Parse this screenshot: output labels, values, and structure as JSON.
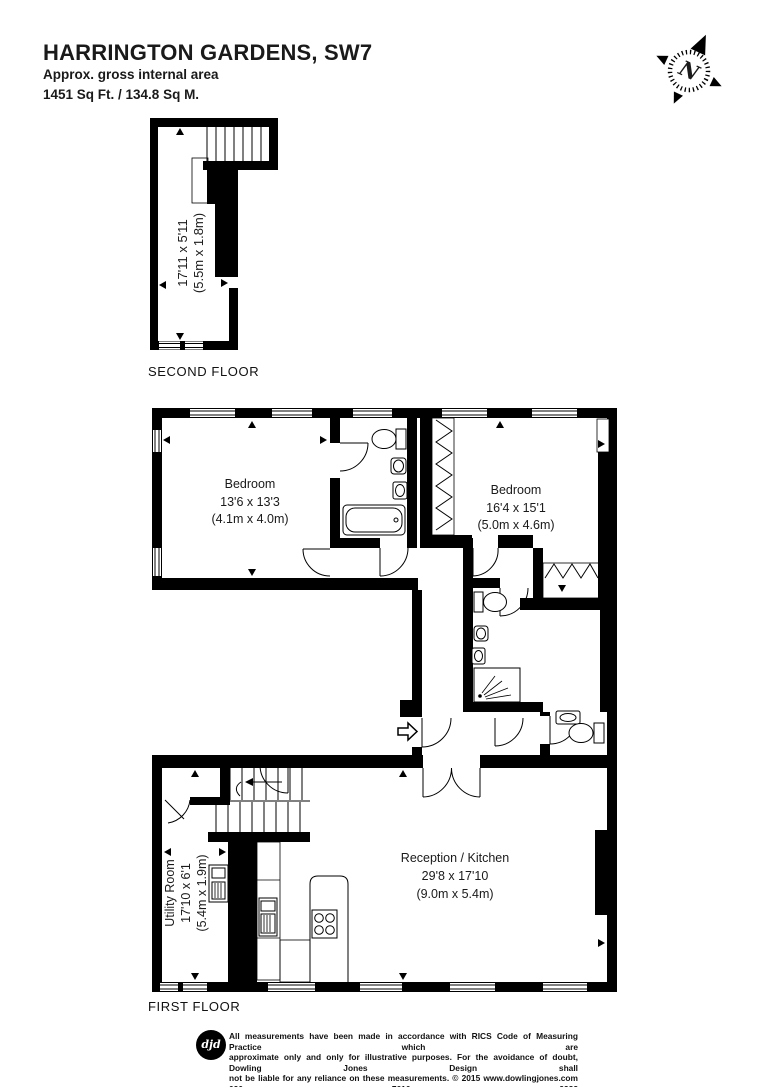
{
  "header": {
    "title": "HARRINGTON GARDENS, SW7",
    "subtitle": "Approx. gross internal area",
    "area": "1451 Sq Ft. / 134.8 Sq M."
  },
  "compass": {
    "label": "N"
  },
  "floors": {
    "second": {
      "label": "SECOND FLOOR",
      "room": {
        "imperial": "17'11 x 5'11",
        "metric": "(5.5m x 1.8m)"
      }
    },
    "first": {
      "label": "FIRST FLOOR",
      "rooms": {
        "bedroom1": {
          "name": "Bedroom",
          "imperial": "13'6 x 13'3",
          "metric": "(4.1m x 4.0m)"
        },
        "bedroom2": {
          "name": "Bedroom",
          "imperial": "16'4 x 15'1",
          "metric": "(5.0m x 4.6m)"
        },
        "reception": {
          "name": "Reception / Kitchen",
          "imperial": "29'8 x 17'10",
          "metric": "(9.0m x 5.4m)"
        },
        "utility": {
          "name": "Utility Room",
          "imperial": "17'10 x 6'1",
          "metric": "(5.4m x 1.9m)"
        }
      }
    }
  },
  "footer": {
    "logo": "djd",
    "lines": [
      "All measurements have been made in accordance with RICS Code of Measuring Practice which are",
      "approximate only and only for illustrative purposes. For the avoidance of doubt, Dowling Jones Design shall",
      "not be liable for any reliance on these measurements. © 2015 www.dowlingjones.com 020 7610 9933"
    ]
  },
  "colors": {
    "wall": "#000000",
    "text": "#1a1a1a",
    "background": "#ffffff"
  }
}
